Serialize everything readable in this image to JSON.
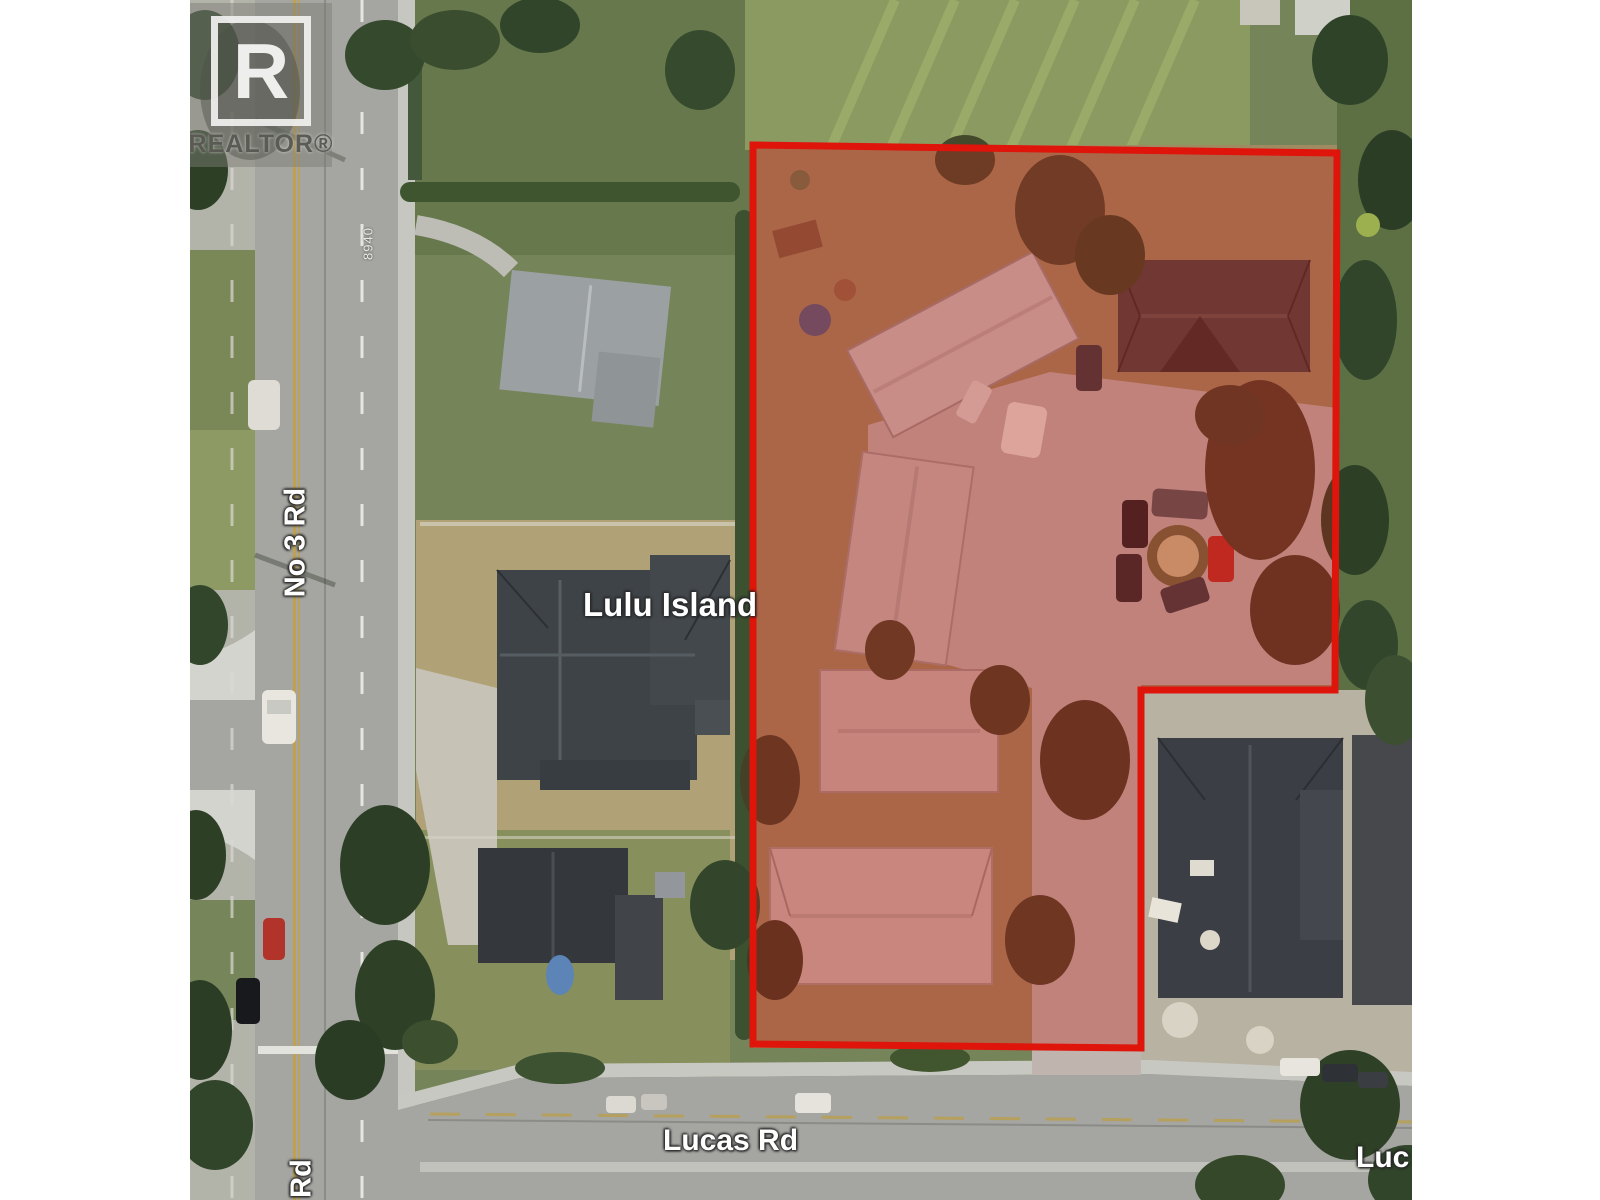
{
  "watermark": {
    "initial": "R",
    "brand": "REALTOR®"
  },
  "labels": {
    "road_left": "No 3 Rd",
    "road_left_partial": "Rd",
    "district": "Lulu Island",
    "road_bottom": "Lucas Rd",
    "road_bottom_partial": "Luc",
    "house_number": "8940"
  },
  "overlay": {
    "boundary_color": "#df140a",
    "boundary_fill": "rgba(195,30,22,0.33)",
    "boundary_width": "7"
  }
}
